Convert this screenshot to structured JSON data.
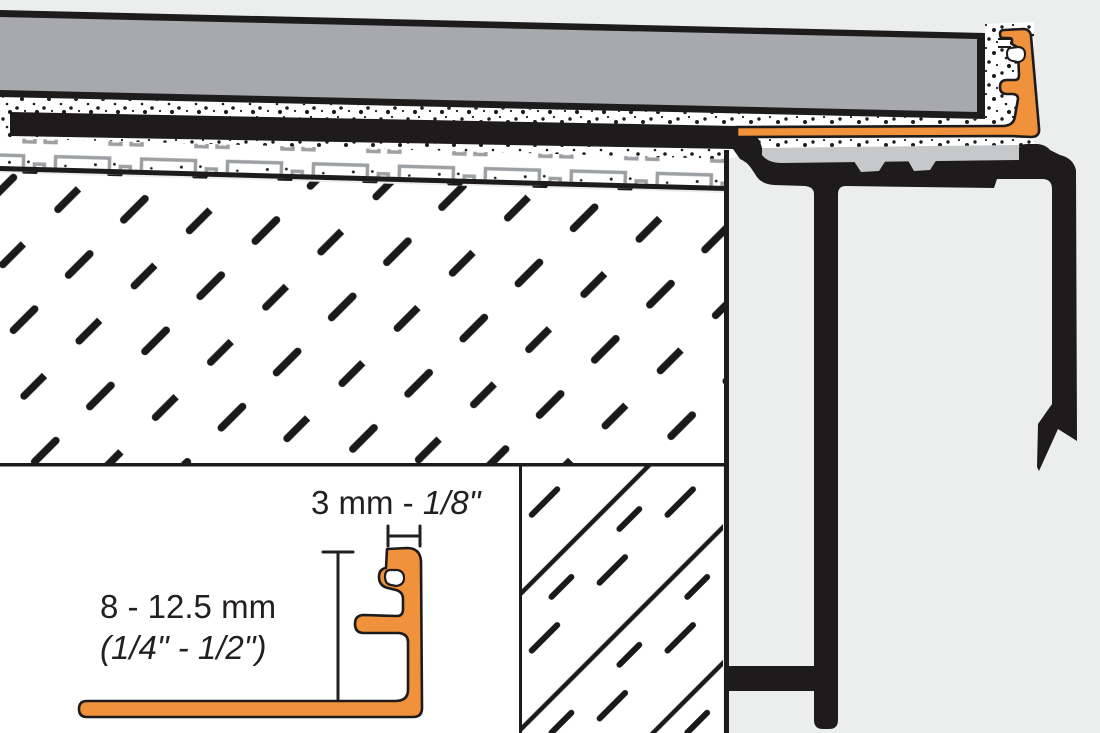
{
  "drawing": {
    "title": "tile-edge-profile-installation-cross-section",
    "inset": {
      "width_dim_prefix": "3 mm - ",
      "width_dim_inches": "1/8\"",
      "height_dim_mm": "8 - 12.5 mm",
      "height_dim_inches": "(1/4\" - 1/2\")"
    },
    "colors": {
      "background": "#ECEDED",
      "white": "#FFFFFF",
      "tile_gray": "#A7A9AC",
      "support_gray": "#C6C8CA",
      "membrane_gray": "#9DA0A3",
      "profile_orange": "#F0923B",
      "line_black": "#231F20"
    }
  }
}
